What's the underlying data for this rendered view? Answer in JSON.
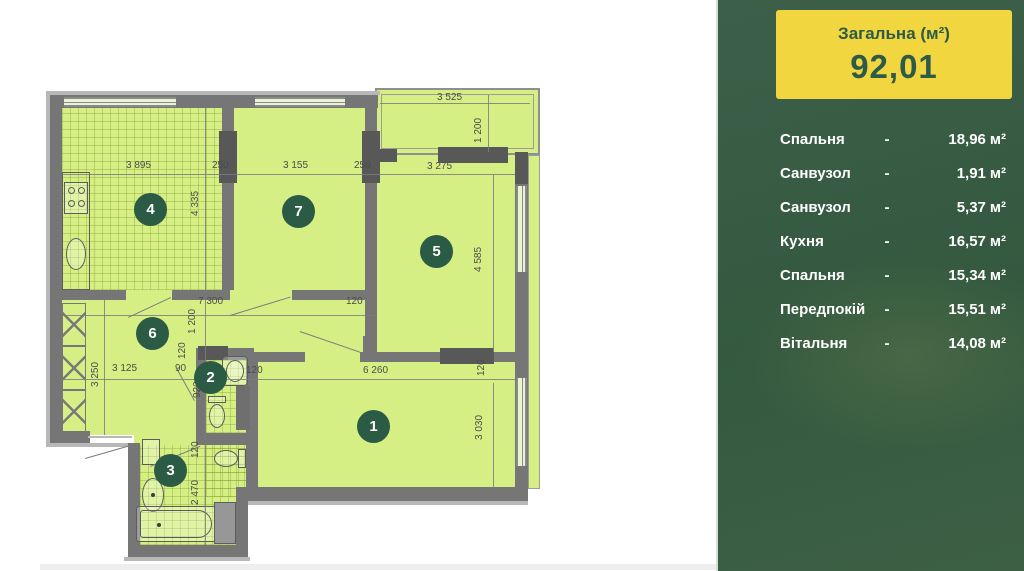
{
  "panel": {
    "title": "Загальна (м²)",
    "total": "92,01",
    "separator": "-",
    "unit": "м²"
  },
  "rooms": [
    {
      "num": "1",
      "name": "Спальня",
      "area": "18,96"
    },
    {
      "num": "2",
      "name": "Санвузол",
      "area": "1,91"
    },
    {
      "num": "3",
      "name": "Санвузол",
      "area": "5,37"
    },
    {
      "num": "4",
      "name": "Кухня",
      "area": "16,57"
    },
    {
      "num": "5",
      "name": "Спальня",
      "area": "15,34"
    },
    {
      "num": "6",
      "name": "Передпокій",
      "area": "15,51"
    },
    {
      "num": "7",
      "name": "Вітальня",
      "area": "14,08"
    }
  ],
  "plan": {
    "dims": [
      "3 895",
      "250",
      "3 155",
      "250",
      "3 275",
      "3 525",
      "1 200",
      "4 335",
      "4 585",
      "7 300",
      "120",
      "1 200",
      "120",
      "3 250",
      "3 125",
      "90",
      "120",
      "6 260",
      "120",
      "3 030",
      "120",
      "2 470",
      "920"
    ]
  },
  "colors": {
    "panel_green": "#35593f",
    "accent_yellow": "#f2d63f",
    "room_fill": "#d6ef85",
    "wall_gray": "#767676",
    "circle_green": "#2b5a45"
  }
}
